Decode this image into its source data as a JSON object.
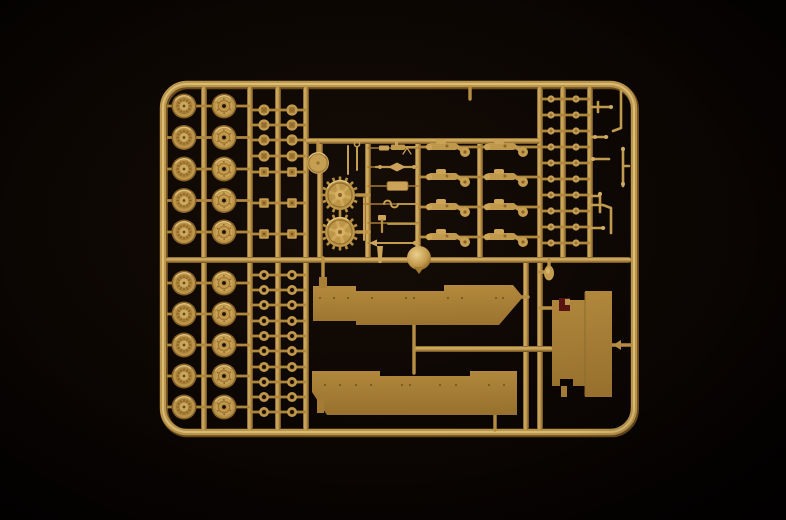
{
  "meta": {
    "type": "product-photo",
    "subject": "tan injection-molded plastic model-kit sprue with tank parts on a black background",
    "visible_text": "none"
  },
  "colors": {
    "background_center": "#160d06",
    "background_mid": "#0c0603",
    "background_edge": "#030100",
    "plastic_base": "#bd9445",
    "plastic_light": "#ecd28d",
    "plastic_dark": "#6e4e1e",
    "plastic_face": "#cda55a",
    "flat_part": "#ad8339",
    "flat_part_dark": "#97722c",
    "hole_dark": "#1c1006",
    "marking_red": "#5a1510"
  },
  "parts_inventory": [
    {
      "part": "road-wheel-ribbed",
      "count": 10
    },
    {
      "part": "road-wheel-hub",
      "count": 10
    },
    {
      "part": "hub-cap-knob",
      "count": 8
    },
    {
      "part": "square-nut",
      "count": 6
    },
    {
      "part": "roller-ring",
      "count": 20
    },
    {
      "part": "track-pin",
      "count": 20
    },
    {
      "part": "suspension-bogie",
      "count": 8
    },
    {
      "part": "drive-sprocket",
      "count": 2
    },
    {
      "part": "idler-disc",
      "count": 1
    },
    {
      "part": "ventilator-dome",
      "count": 1
    },
    {
      "part": "oval-part",
      "count": 1
    },
    {
      "part": "pioneer-tool",
      "count": 7
    },
    {
      "part": "thin-rod",
      "count": 3
    },
    {
      "part": "bracket-part",
      "count": 9
    },
    {
      "part": "fender",
      "count": 2
    },
    {
      "part": "hull-plate",
      "count": 1
    }
  ],
  "layout_spec": {
    "frame": {
      "x": 163,
      "y": 84,
      "w": 471,
      "h": 348,
      "rx": 24
    },
    "verticals": [
      {
        "x": 204,
        "y1": 87,
        "y2": 430
      },
      {
        "x": 250,
        "y1": 87,
        "y2": 430
      },
      {
        "x": 278,
        "y1": 87,
        "y2": 430
      },
      {
        "x": 306,
        "y1": 87,
        "y2": 430
      },
      {
        "x": 320,
        "y1": 142,
        "y2": 260
      },
      {
        "x": 368,
        "y1": 140,
        "y2": 260
      },
      {
        "x": 418,
        "y1": 140,
        "y2": 260
      },
      {
        "x": 480,
        "y1": 140,
        "y2": 260
      },
      {
        "x": 540,
        "y1": 87,
        "y2": 430
      },
      {
        "x": 563,
        "y1": 87,
        "y2": 260
      },
      {
        "x": 590,
        "y1": 87,
        "y2": 260
      },
      {
        "x": 526,
        "y1": 260,
        "y2": 430
      }
    ],
    "horizontals": [
      {
        "y": 141,
        "x1": 306,
        "x2": 540
      },
      {
        "y": 260,
        "x1": 166,
        "x2": 631
      },
      {
        "y": 349,
        "x1": 414,
        "x2": 553
      }
    ],
    "stubs_v": [
      {
        "x": 323,
        "y1": 258,
        "y2": 288
      },
      {
        "x": 414,
        "y1": 323,
        "y2": 373
      },
      {
        "x": 495,
        "y1": 413,
        "y2": 430
      },
      {
        "x": 470,
        "y1": 88,
        "y2": 99
      },
      {
        "x": 318,
        "y1": 142,
        "y2": 153
      },
      {
        "x": 549,
        "y1": 260,
        "y2": 266
      }
    ],
    "stubs_h": [
      {
        "y": 297,
        "x1": 517,
        "x2": 528
      },
      {
        "y": 308,
        "x1": 540,
        "x2": 553
      },
      {
        "y": 345,
        "x1": 612,
        "x2": 631
      },
      {
        "y": 272,
        "x1": 540,
        "x2": 546
      },
      {
        "y": 195,
        "x1": 357,
        "x2": 369
      },
      {
        "y": 232,
        "x1": 357,
        "x2": 369
      }
    ],
    "arrow_gate": [
      [
        613,
        345
      ],
      [
        621,
        340
      ],
      [
        621,
        350
      ]
    ],
    "wheel_rows_top": [
      106,
      137.5,
      169,
      200.5,
      232
    ],
    "wheel_rows_bottom": [
      283,
      314,
      345,
      376,
      407
    ],
    "wheels_ribbed": {
      "cx": 184,
      "axle": [
        167,
        204
      ]
    },
    "wheels_hub": {
      "cx": 224,
      "axle": [
        204,
        250
      ]
    },
    "small_cols": [
      {
        "cx": 264,
        "axle": [
          250,
          278
        ]
      },
      {
        "cx": 292,
        "axle": [
          278,
          306
        ]
      }
    ],
    "knob_rows": [
      110,
      125,
      140,
      156
    ],
    "square_rows": [
      172,
      203,
      234
    ],
    "ring_rows": [
      275,
      290,
      305,
      321,
      336,
      351,
      367,
      382,
      397,
      412
    ],
    "pin_cols": [
      {
        "cx": 551,
        "axle": [
          540,
          563
        ]
      },
      {
        "cx": 576,
        "axle": [
          563,
          590
        ]
      }
    ],
    "pin_rows": [
      99,
      115,
      131,
      147,
      163,
      179,
      195,
      211,
      227,
      243
    ],
    "bogie_cols": [
      {
        "cx": 449,
        "axle": [
          418,
          480
        ]
      },
      {
        "cx": 507,
        "axle": [
          480,
          540
        ]
      }
    ],
    "bogie_rows": [
      147,
      177,
      207,
      237
    ],
    "sprockets": [
      {
        "cx": 340,
        "cy": 195
      },
      {
        "cx": 340,
        "cy": 232
      }
    ],
    "disc": {
      "cx": 318,
      "cy": 163,
      "r": 11
    },
    "dome": {
      "cx": 419,
      "cy": 258,
      "r": 12
    },
    "oval": {
      "cx": 549,
      "cy": 273,
      "rx": 5,
      "ry": 7.5
    },
    "thin_rods": [
      {
        "x": 348,
        "y1": 146,
        "y2": 174,
        "ring": 0
      },
      {
        "x": 357,
        "y1": 147,
        "y2": 170,
        "ring": 1
      },
      {
        "x": 364,
        "y1": 198,
        "y2": 240,
        "ring": 0
      }
    ],
    "tools": {
      "gate": [
        368,
        418
      ],
      "items": [
        {
          "name": "machine-gun",
          "y": 148
        },
        {
          "name": "rod-bundle",
          "y": 167
        },
        {
          "name": "cylinder",
          "y": 186
        },
        {
          "name": "hook",
          "y": 204
        },
        {
          "name": "mallet",
          "y": 223
        },
        {
          "name": "cleaning-rod",
          "y": 243
        },
        {
          "name": "barrel",
          "y": 252
        }
      ]
    },
    "fender_top": {
      "poly": [
        [
          313,
          286
        ],
        [
          356,
          286
        ],
        [
          356,
          291
        ],
        [
          444,
          291
        ],
        [
          444,
          285
        ],
        [
          513,
          285
        ],
        [
          523,
          297
        ],
        [
          499,
          325
        ],
        [
          356,
          325
        ],
        [
          356,
          321
        ],
        [
          313,
          321
        ]
      ],
      "tab": [
        319,
        277,
        8,
        11
      ],
      "rivets_y": 298,
      "rivets_x": [
        320,
        334,
        348,
        372,
        406,
        414,
        448,
        462,
        496,
        503
      ]
    },
    "fender_bottom": {
      "poly": [
        [
          312,
          371
        ],
        [
          380,
          371
        ],
        [
          380,
          376
        ],
        [
          470,
          376
        ],
        [
          470,
          371
        ],
        [
          517,
          371
        ],
        [
          517,
          415
        ],
        [
          327,
          415
        ],
        [
          312,
          392
        ]
      ],
      "tab": [
        317,
        399,
        7,
        14
      ],
      "rivets_y": 385,
      "rivets_x": [
        325,
        340,
        356,
        371,
        402,
        410,
        440,
        456,
        489,
        504
      ]
    },
    "hull": {
      "poly": [
        [
          552,
          300
        ],
        [
          585,
          300
        ],
        [
          585,
          291
        ],
        [
          612,
          291
        ],
        [
          612,
          397
        ],
        [
          585,
          397
        ],
        [
          585,
          386
        ],
        [
          573,
          386
        ],
        [
          573,
          379
        ],
        [
          560,
          379
        ],
        [
          560,
          386
        ],
        [
          552,
          386
        ]
      ],
      "tab": [
        561,
        386,
        6,
        11
      ],
      "mark_red": [
        559,
        298,
        11,
        13
      ],
      "mark_tan": [
        565,
        299,
        5,
        6
      ],
      "seam_x": 585
    },
    "lparts": [
      {
        "d": "M590,107 H610",
        "dots": [
          [
            611,
            107
          ]
        ]
      },
      {
        "d": "M598,102 V112",
        "dots": []
      },
      {
        "d": "M621,91 V128 L613,131",
        "dots": []
      },
      {
        "d": "M590,137 H607",
        "dots": [
          [
            595,
            137
          ],
          [
            606,
            137
          ]
        ]
      },
      {
        "d": "M593,159 H609",
        "dots": [
          [
            593,
            159
          ]
        ]
      },
      {
        "d": "M623,148 V186 M623,166 H629",
        "dots": [
          [
            623,
            149
          ],
          [
            623,
            184
          ]
        ]
      },
      {
        "d": "M600,193 V212 M590,196 H600",
        "dots": [
          [
            600,
            194
          ]
        ]
      },
      {
        "d": "M611,233 V208 L603,205 H590",
        "dots": []
      },
      {
        "d": "M590,228 H604",
        "dots": [
          [
            603,
            228
          ]
        ]
      }
    ]
  }
}
